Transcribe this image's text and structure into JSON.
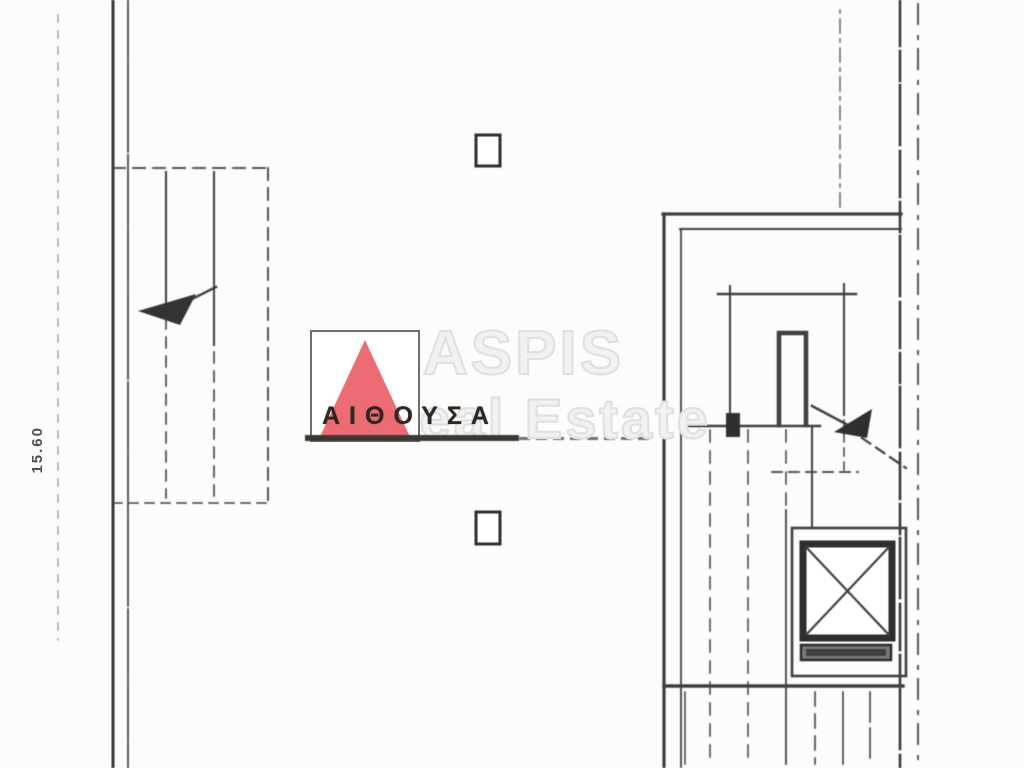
{
  "plan": {
    "dimension_label": "15.60",
    "room_label": "ΑΙΘΟΥΣΑ"
  },
  "watermark": {
    "line1": "ASPIS",
    "line2": "Real Estate",
    "color": "#e2e0e0"
  },
  "logo": {
    "shape": "red-triangle",
    "triangle_color": "#ed6b72",
    "border_color": "#6e6e6e"
  },
  "colors": {
    "ink": "#3c3c3c",
    "paper": "#fcfcfb"
  }
}
